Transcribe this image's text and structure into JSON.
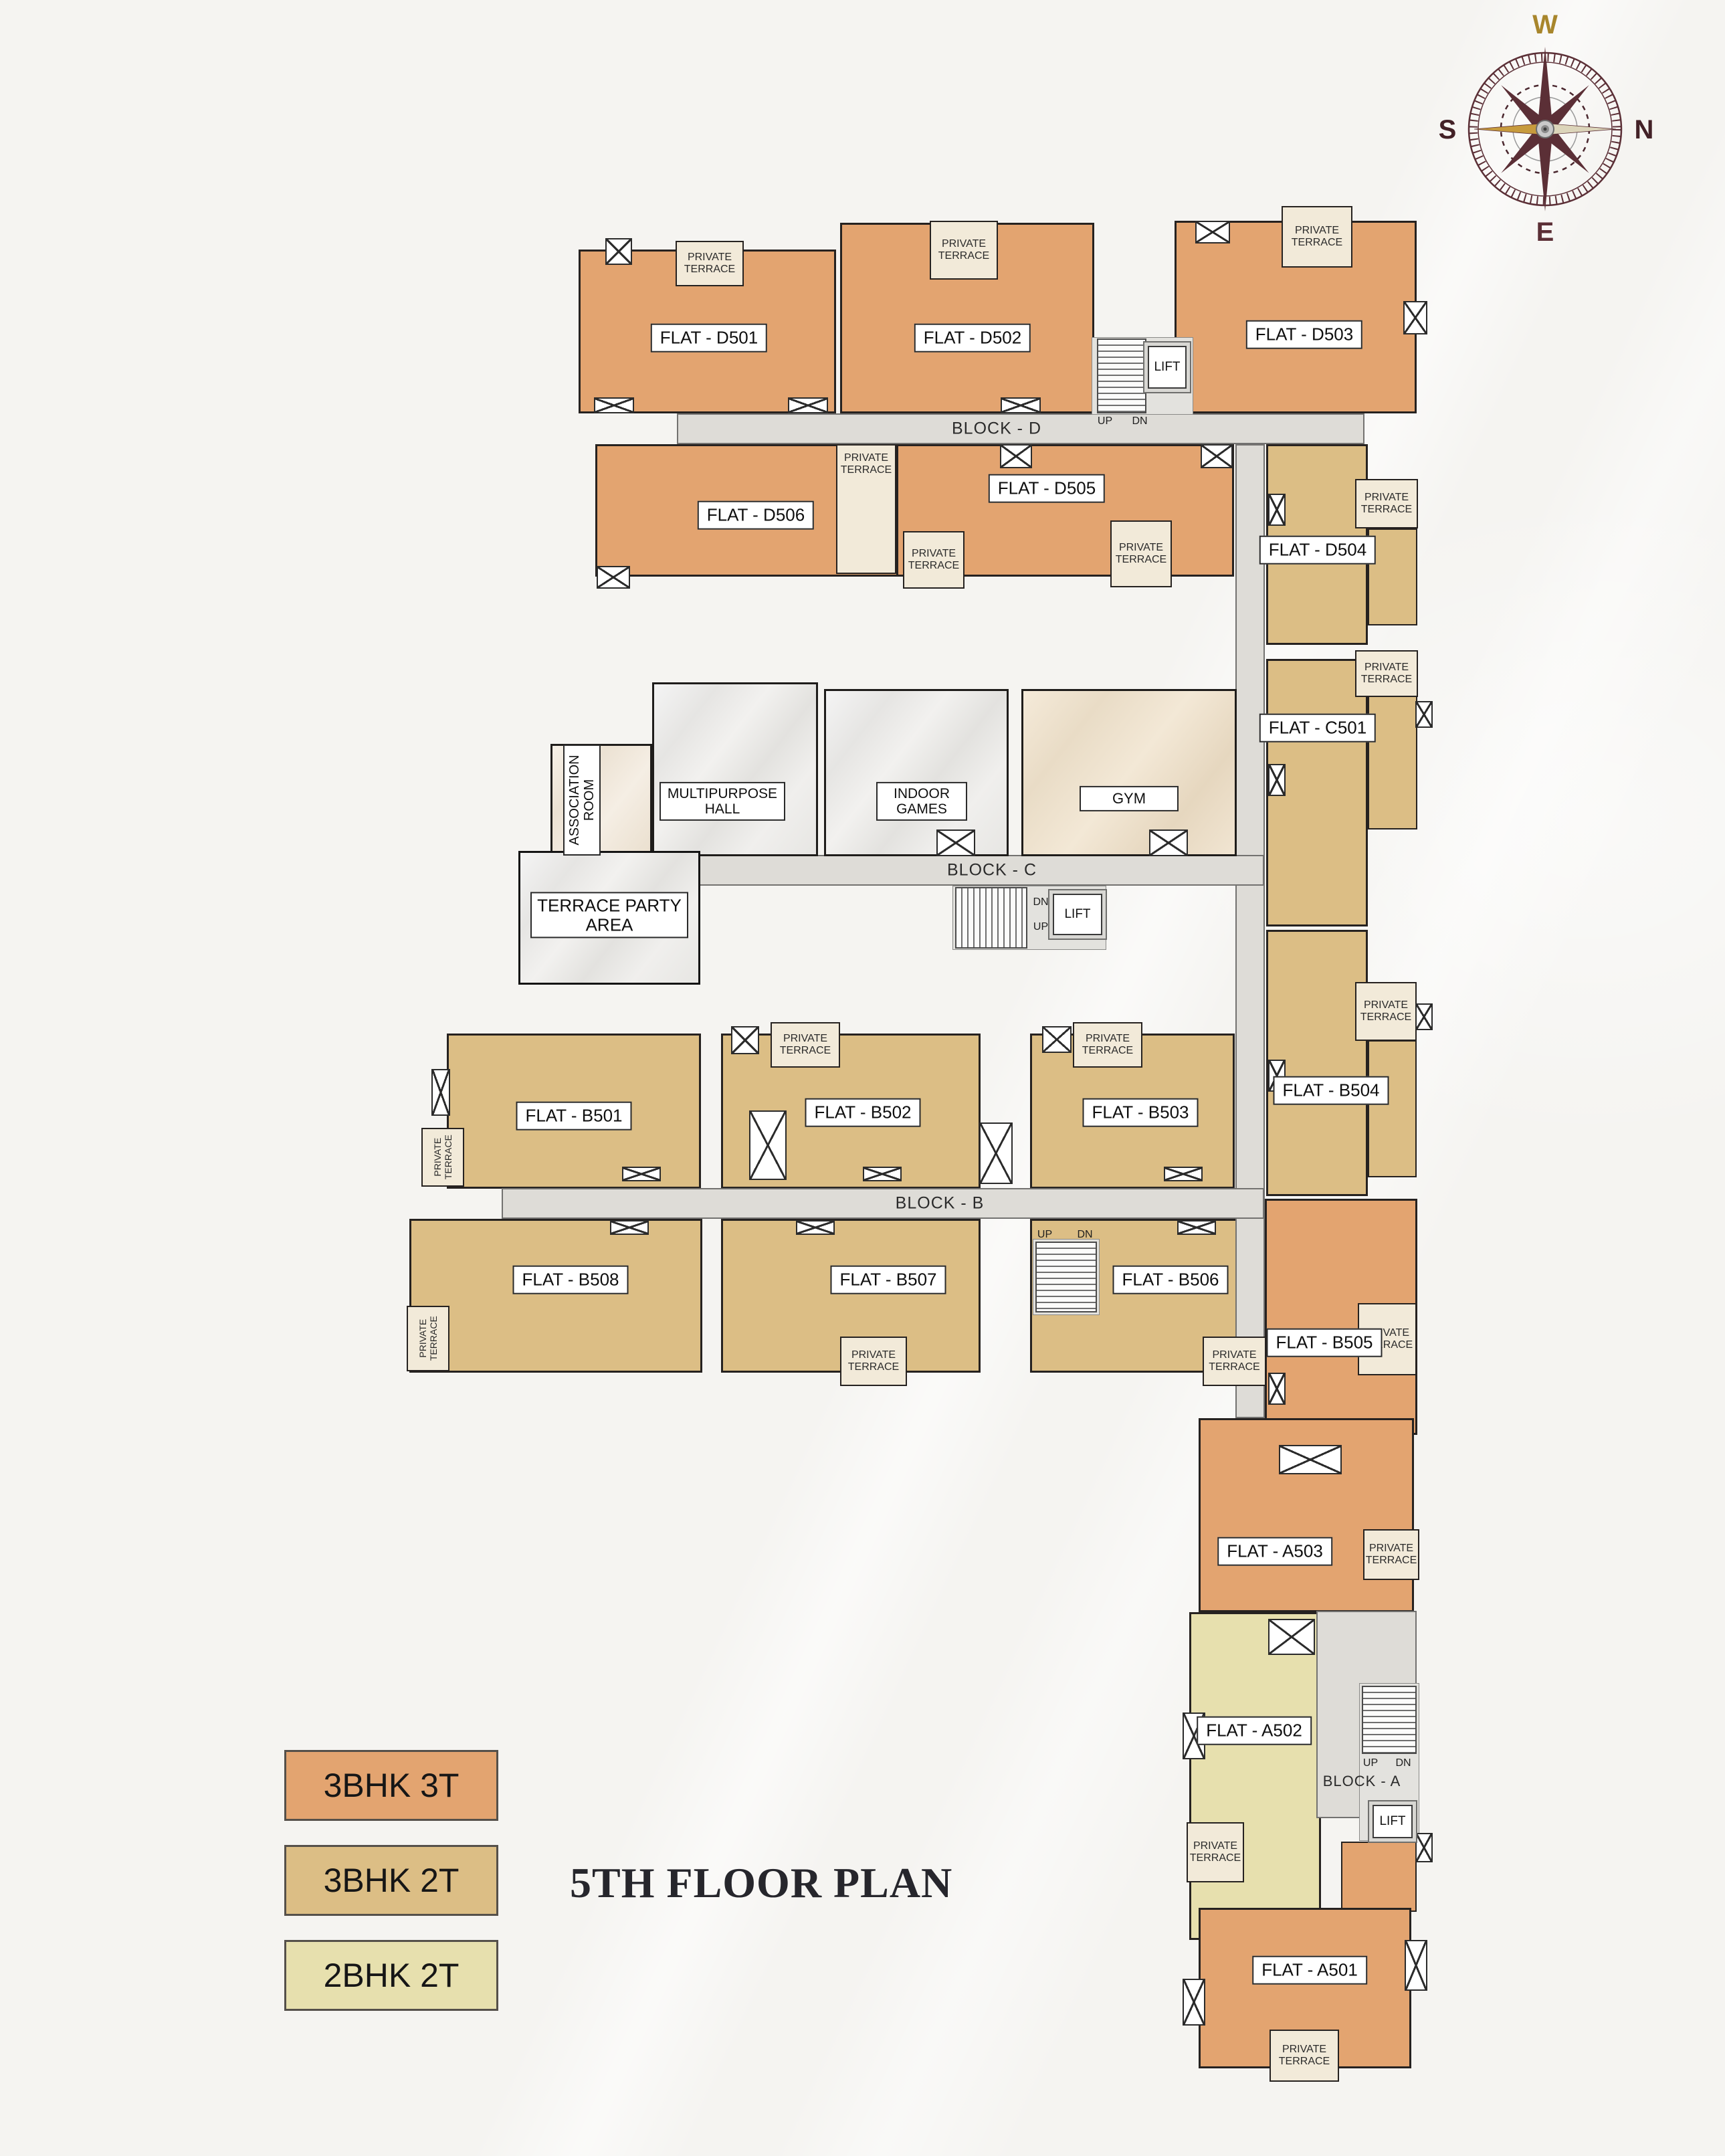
{
  "title": "5TH FLOOR PLAN",
  "compass": {
    "top": "W",
    "right": "N",
    "left": "S",
    "bottom": "E"
  },
  "strings": {
    "private_terrace": "PRIVATE TERRACE",
    "lift": "LIFT",
    "up": "UP",
    "dn": "DN"
  },
  "blocks": {
    "d": "BLOCK - D",
    "c": "BLOCK - C",
    "b": "BLOCK - B",
    "a": "BLOCK - A"
  },
  "flats": {
    "d501": "FLAT - D501",
    "d502": "FLAT - D502",
    "d503": "FLAT - D503",
    "d504": "FLAT - D504",
    "d505": "FLAT - D505",
    "d506": "FLAT - D506",
    "c501": "FLAT - C501",
    "b501": "FLAT - B501",
    "b502": "FLAT - B502",
    "b503": "FLAT - B503",
    "b504": "FLAT - B504",
    "b505": "FLAT - B505",
    "b506": "FLAT - B506",
    "b507": "FLAT - B507",
    "b508": "FLAT - B508",
    "a501": "FLAT - A501",
    "a502": "FLAT - A502",
    "a503": "FLAT - A503"
  },
  "amenities": {
    "association_room": "ASSOCIATION ROOM",
    "multipurpose_hall": "MULTIPURPOSE HALL",
    "indoor_games": "INDOOR GAMES",
    "gym": "GYM",
    "terrace_party_area": "TERRACE PARTY AREA"
  },
  "legend": [
    {
      "label": "3BHK 3T",
      "color": "#E3A470"
    },
    {
      "label": "3BHK 2T",
      "color": "#DCBE85"
    },
    {
      "label": "2BHK 2T",
      "color": "#E7E0AE"
    }
  ],
  "colors": {
    "flat_3bhk_3t": "#E3A470",
    "flat_3bhk_2t": "#DCBE85",
    "flat_2bhk_2t": "#E7E0AE",
    "private_terrace": "#F2EAD9",
    "corridor": "#DEDCD7",
    "background": "#F5F4F1"
  }
}
